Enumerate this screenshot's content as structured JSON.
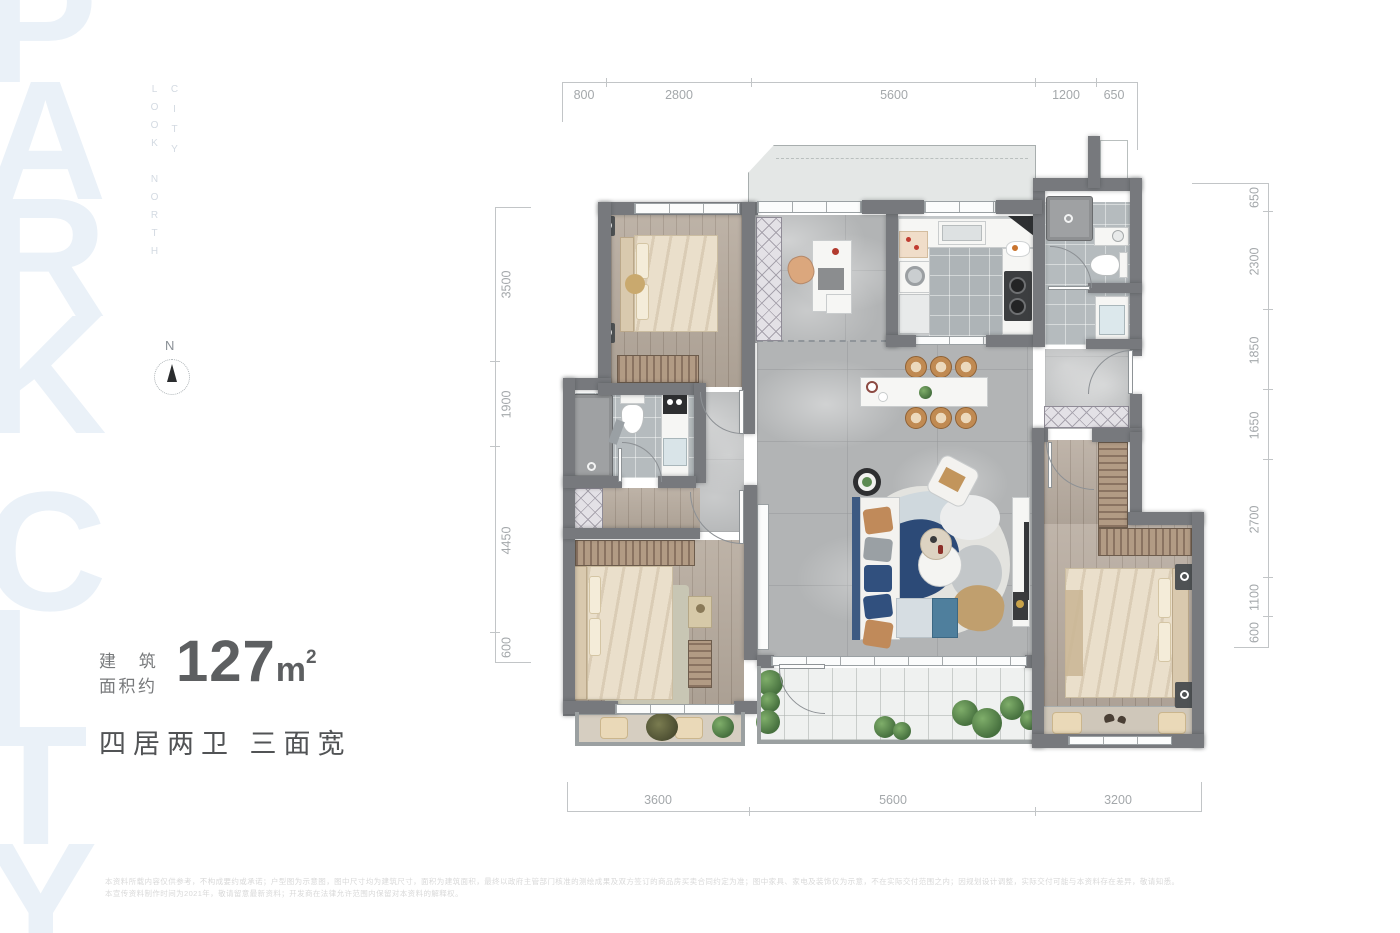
{
  "watermark": {
    "line1": "PARK",
    "line2": "CITY"
  },
  "corner_label": {
    "right_column": "CITY",
    "left_column": "LOOK NORTH"
  },
  "compass": {
    "north": "N"
  },
  "info": {
    "label_line1": "建 筑",
    "label_line2": "面积约",
    "area_number": "127",
    "area_unit": "m",
    "area_sup": "2",
    "tagline": "四居两卫 三面宽"
  },
  "dimensions": {
    "top": [
      "800",
      "2800",
      "5600",
      "1200",
      "650"
    ],
    "bottom": [
      "3600",
      "5600",
      "3200"
    ],
    "left": [
      "3500",
      "1900",
      "4450",
      "600"
    ],
    "right": [
      "650",
      "2300",
      "1850",
      "1650",
      "2700",
      "1100",
      "600"
    ]
  },
  "disclaimer": {
    "line1": "本资料所载内容仅供参考，不构成要约或承诺；户型图为示意图，图中尺寸均为建筑尺寸，面积为建筑面积，最终以政府主管部门核准的测绘成果及双方签订的商品房买卖合同约定为准；图中家具、家电及装饰仅为示意，不在实际交付范围之内；因规划设计调整，实际交付可能与本资料存在差异，敬请知悉。",
    "line2": "本宣传资料制作时间为2021年，敬请留意最新资料；开发商在法律允许范围内保留对本资料的解释权。"
  }
}
